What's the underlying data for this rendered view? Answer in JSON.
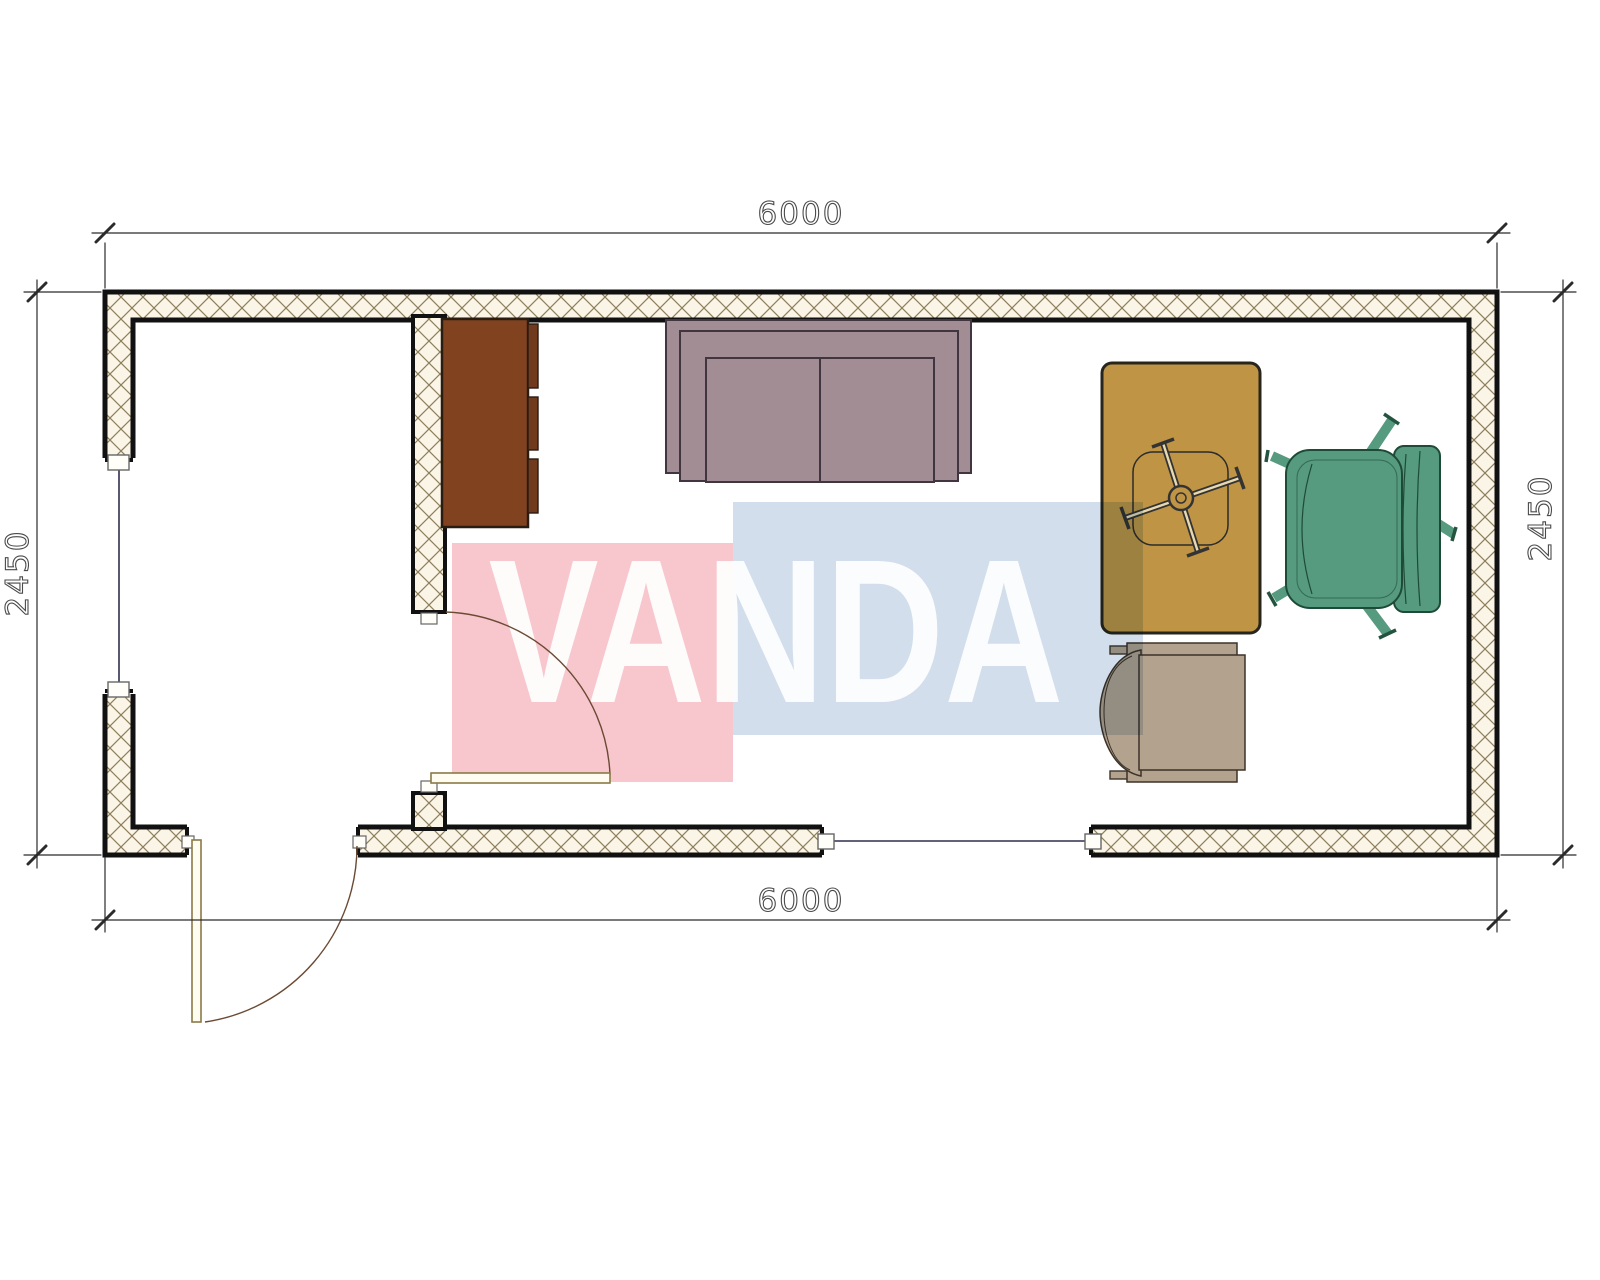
{
  "drawing": {
    "type": "floor-plan",
    "watermark_text": "VANDA",
    "dim_top": "6000",
    "dim_bottom": "6000",
    "dim_left": "2450",
    "dim_right": "2450",
    "units": "mm",
    "room_outer_width_mm": 6000,
    "room_outer_depth_mm": 2450,
    "elements": [
      "exterior-walls",
      "interior-partition-wall",
      "entrance-door",
      "interior-door",
      "left-window",
      "bottom-window",
      "wardrobe-cabinet",
      "sofa",
      "desk",
      "desk-task-chair",
      "green-armchair",
      "tan-side-chair"
    ]
  },
  "colors": {
    "paper": "#ffffff",
    "wall_fill": "#faf5e7",
    "hatch_line": "#8d7f5c",
    "wall_stroke": "#111111",
    "window_line": "#2e2e4e",
    "sill_stroke": "#666666",
    "door_leaf": "#8a7a45",
    "door_arc": "#6b4a33",
    "dim_line": "#2b2b2b",
    "dim_text": "#4a4a4a",
    "cabinet": "#81431f",
    "cabinet_front": "#6f3a1e",
    "sofa": "#a28d95",
    "sofa_stroke": "#41353f",
    "desk": "#bf9445",
    "desk_stroke": "#27251c",
    "chair_green": "#569a7f",
    "chair_green_stroke": "#1d4b38",
    "chair_tan": "#b3a28d",
    "chair_tan_stroke": "#3c332a",
    "watermark_pink": "#f8c7ce",
    "watermark_blue": "#d2deeb",
    "watermark_letters": "#ffffff"
  }
}
